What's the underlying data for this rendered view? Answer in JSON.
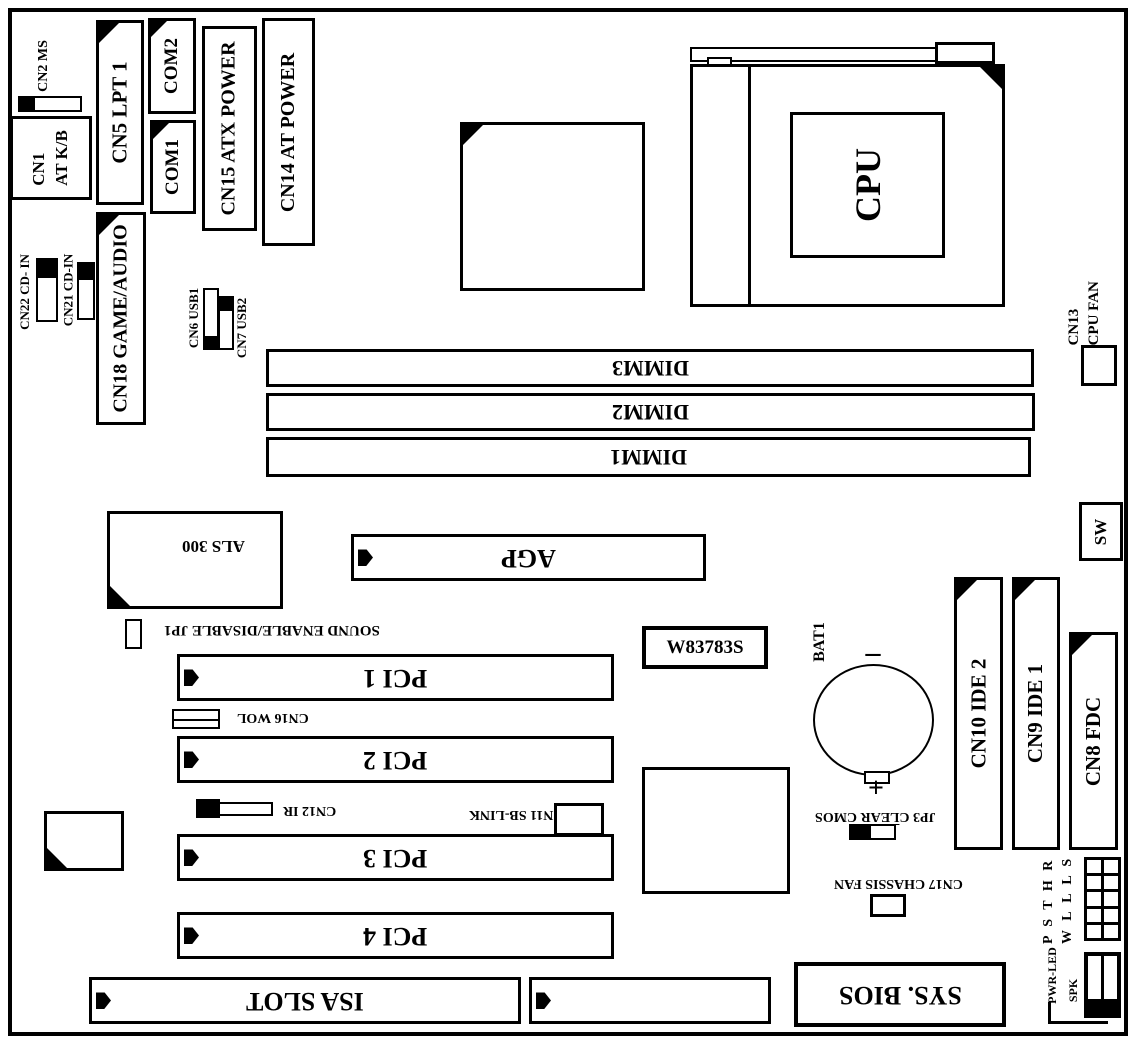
{
  "colors": {
    "ink": "#000000",
    "paper": "#ffffff"
  },
  "board": {
    "rear_io": {
      "cn2_ms": "CN2 MS",
      "cn1_line1": "CN1",
      "cn1_line2": "AT K/B",
      "lpt": "CN5  LPT 1",
      "com2": "COM2",
      "com1": "COM1",
      "atx_power": "CN15 ATX POWER",
      "at_power": "CN14  AT POWER",
      "game_audio": "CN18 GAME/AUDIO",
      "cd_in_22": "CN22 CD- IN",
      "cd_in_21": "CN21 CD-IN",
      "usb1": "CN6 USB1",
      "usb2": "CN7 USB2"
    },
    "cpu": {
      "label": "CPU",
      "fan_line1": "CN13",
      "fan_line2": "CPU FAN"
    },
    "memory": {
      "dimm3": "DIMM3",
      "dimm2": "DIMM2",
      "dimm1": "DIMM1"
    },
    "sw": "SW",
    "chips": {
      "als": "ALS 300",
      "hw_monitor": "W83783S",
      "bios": "SYS. BIOS"
    },
    "slots": {
      "agp": "AGP",
      "pci1": "PCI 1",
      "pci2": "PCI 2",
      "pci3": "PCI 3",
      "pci4": "PCI 4",
      "isa": "ISA SLOT"
    },
    "jumpers": {
      "sound": "SOUND ENABLE/DISABLE  JP1",
      "wol": "CN16 WOL",
      "ir": "CN12 IR",
      "sblink": "CN11  SB-LINK",
      "jp3_prefix": "JP3 C",
      "jp3_overline": "LE",
      "jp3_suffix": "AR CMOS",
      "chassis_fan": "CN17  CHASSIS FAN"
    },
    "battery": {
      "label": "BAT1",
      "minus": "–",
      "plus": "+"
    },
    "storage": {
      "ide2": "CN10  IDE 2",
      "ide1": "CN9  IDE 1",
      "fdc": "CN8  FDC"
    },
    "front_panel": {
      "row1": "P S T H R",
      "row2": "W L L L S",
      "pwr_led": "PWR-LED",
      "spk": "SPK"
    }
  }
}
